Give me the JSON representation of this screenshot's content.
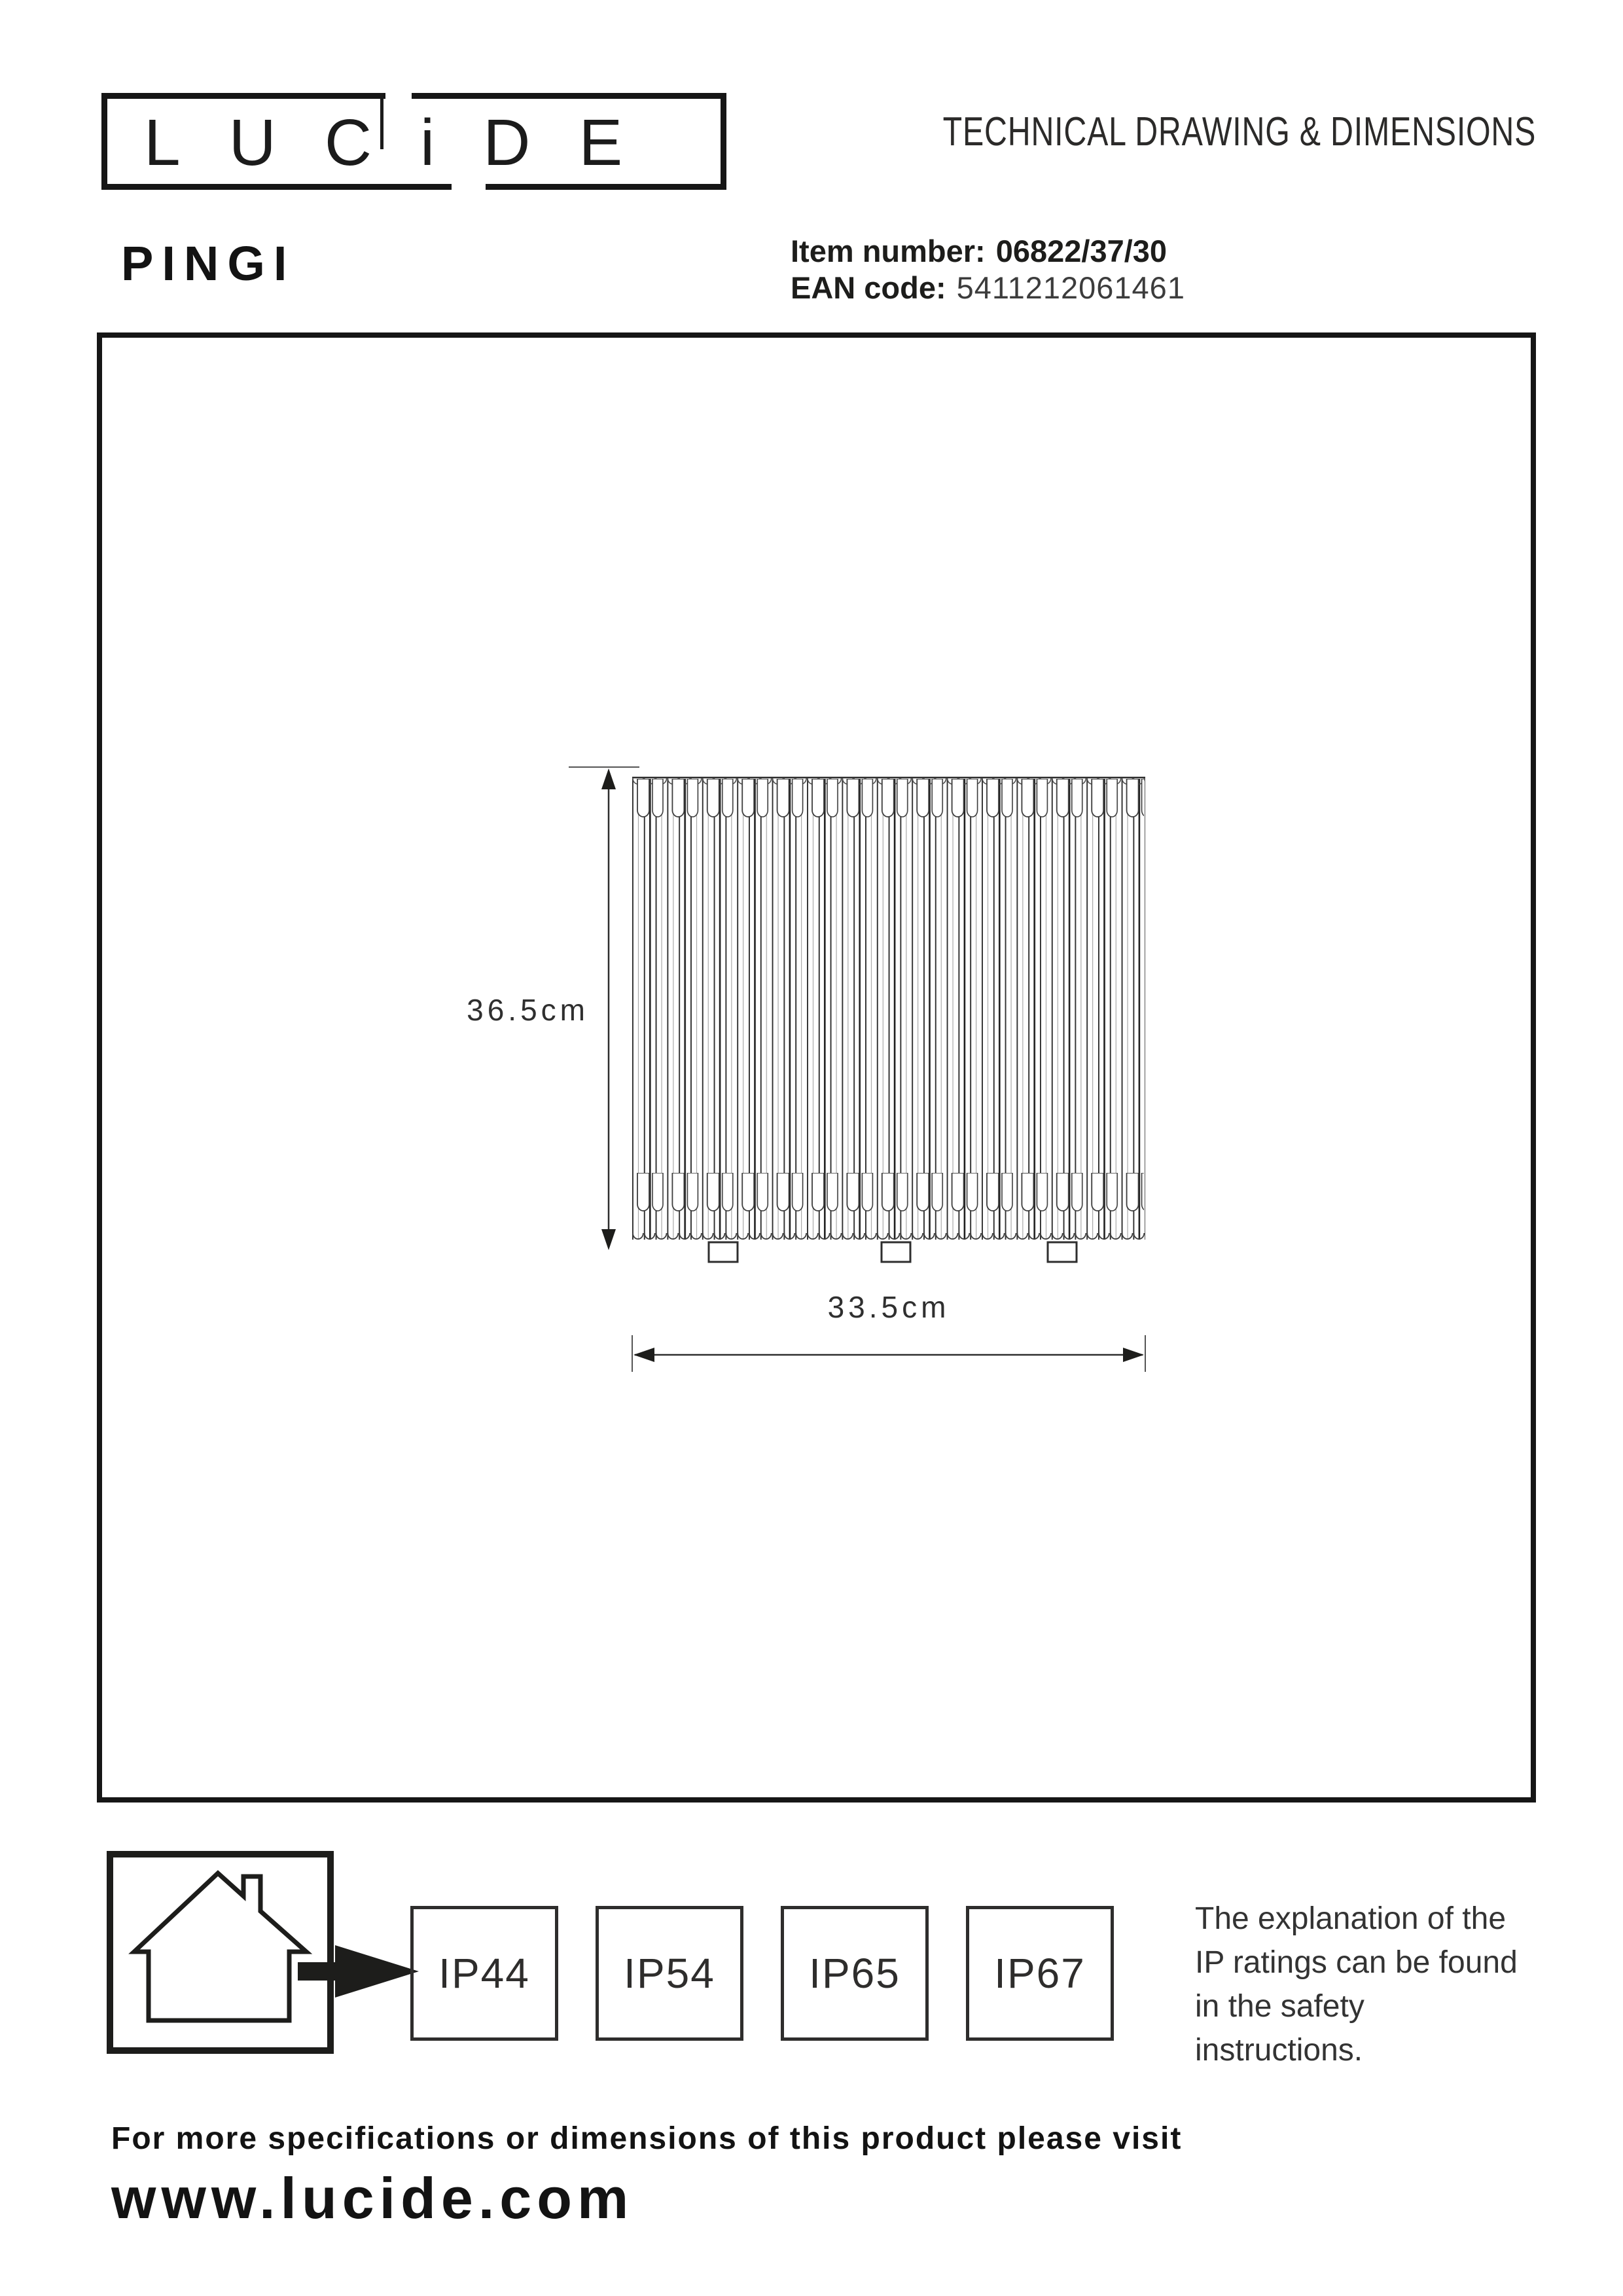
{
  "brand": {
    "logo_text": "LUCiDE"
  },
  "header": {
    "doc_title": "TECHNICAL DRAWING & DIMENSIONS",
    "product_name": "PINGI",
    "item_number_label": "Item number:",
    "item_number_value": "06822/37/30",
    "ean_label": "EAN code:",
    "ean_value": "5411212061461"
  },
  "drawing": {
    "height_label": "36.5cm",
    "width_label": "33.5cm"
  },
  "ip_section": {
    "ratings": [
      "IP44",
      "IP54",
      "IP65",
      "IP67"
    ],
    "note_lines": [
      "The explanation of the",
      "IP ratings can be found",
      "in the safety",
      "instructions."
    ]
  },
  "footer": {
    "line1": "For more specifications or dimensions of this product please visit",
    "website": "www.lucide.com"
  },
  "colors": {
    "ink": "#1d1d1b",
    "line": "#3a3a3a"
  }
}
